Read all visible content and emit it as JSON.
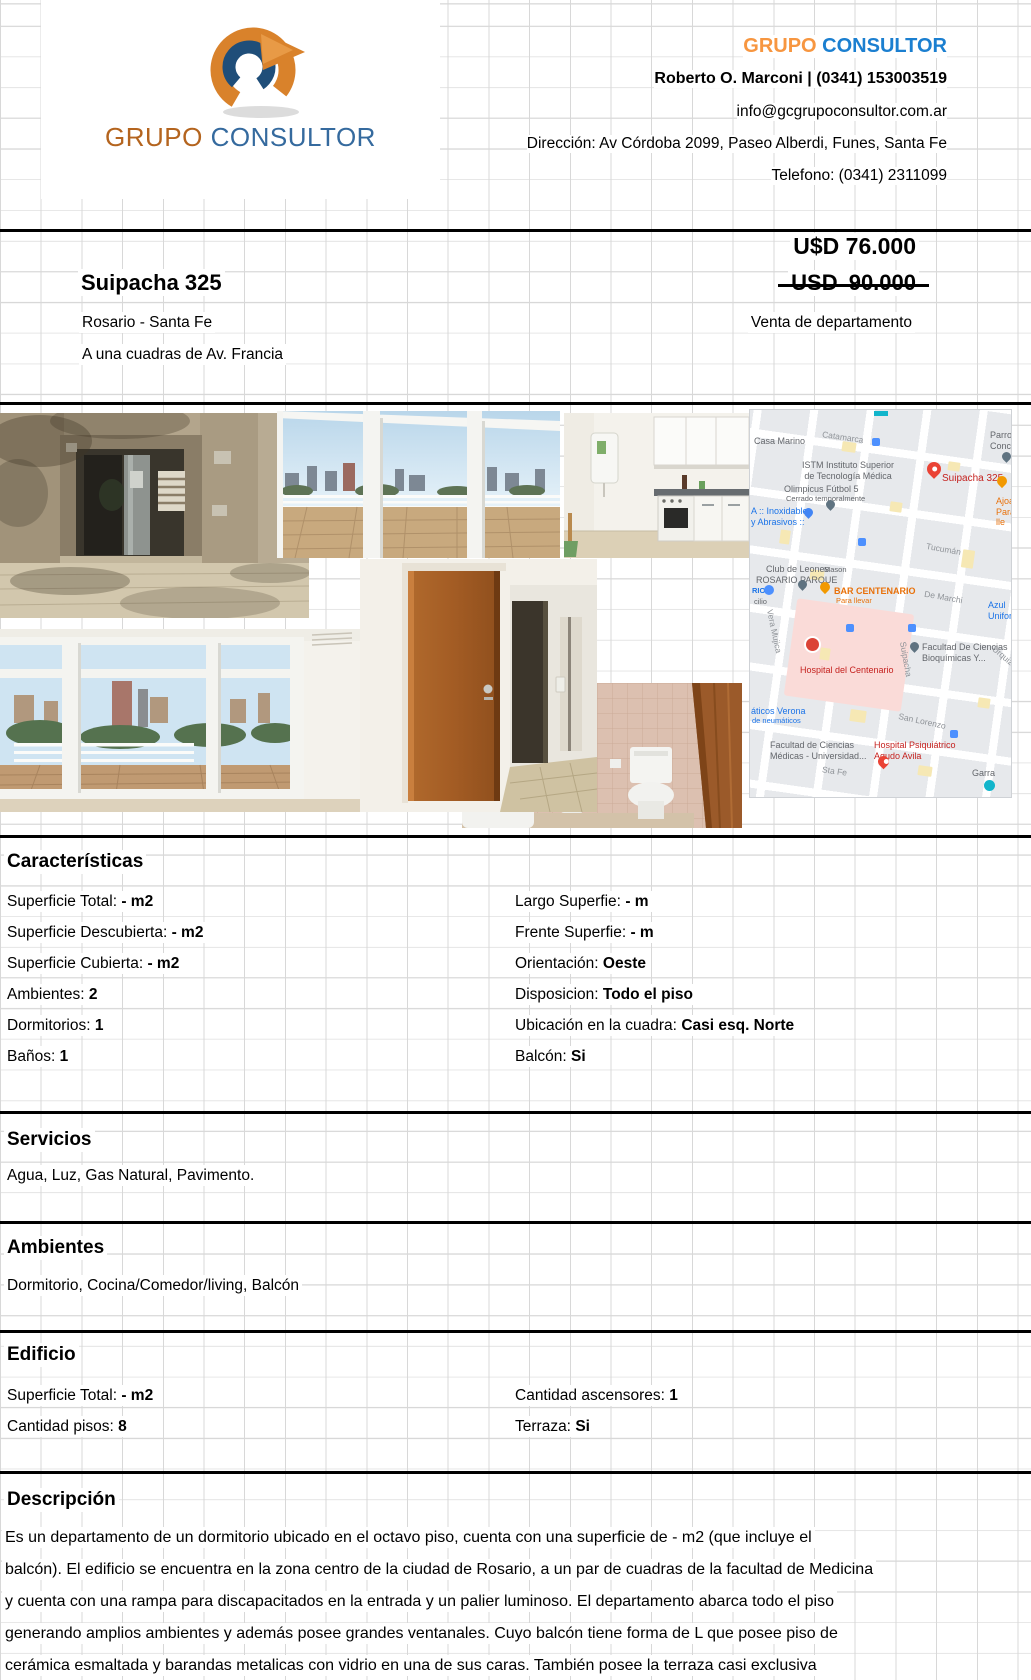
{
  "header": {
    "logo_grupo": "GRUPO",
    "logo_consultor": "CONSULTOR",
    "brand_grupo": "GRUPO",
    "brand_consultor": "CONSULTOR",
    "agent": "Roberto O. Marconi  |  (0341) 153003519",
    "email": "info@gcgrupoconsultor.com.ar",
    "address": "Dirección: Av Córdoba 2099, Paseo Alberdi, Funes, Santa Fe",
    "phone": "Telefono: (0341) 2311099"
  },
  "listing": {
    "price": "U$D 76.000",
    "old_price": "USD  90.000",
    "title": "Suipacha 325",
    "city": "Rosario - Santa Fe",
    "operation": "Venta de departamento",
    "note": "A una cuadras de Av. Francia"
  },
  "caracteristicas": {
    "heading": "Características",
    "left": [
      {
        "label": "Superficie Total:",
        "value": "- m2"
      },
      {
        "label": "Superficie Descubierta:",
        "value": "- m2"
      },
      {
        "label": "Superficie Cubierta:",
        "value": "- m2"
      },
      {
        "label": "Ambientes:",
        "value": "2"
      },
      {
        "label": "Dormitorios:",
        "value": "1"
      },
      {
        "label": "Baños:",
        "value": "1"
      }
    ],
    "right": [
      {
        "label": "Largo Superfie:",
        "value": "- m"
      },
      {
        "label": "Frente Superfie:",
        "value": "- m"
      },
      {
        "label": "Orientación:",
        "value": "Oeste"
      },
      {
        "label": "Disposicion:",
        "value": "Todo el piso"
      },
      {
        "label": "Ubicación en la cuadra:",
        "value": "Casi esq. Norte"
      },
      {
        "label": "Balcón:",
        "value": "Si"
      }
    ]
  },
  "servicios": {
    "heading": "Servicios",
    "text": "Agua, Luz, Gas Natural, Pavimento."
  },
  "ambientes": {
    "heading": "Ambientes",
    "text": "Dormitorio, Cocina/Comedor/living, Balcón"
  },
  "edificio": {
    "heading": "Edificio",
    "left": [
      {
        "label": "Superficie Total:",
        "value": "- m2"
      },
      {
        "label": "Cantidad pisos:",
        "value": "8"
      }
    ],
    "right": [
      {
        "label": "Cantidad ascensores:",
        "value": "1"
      },
      {
        "label": "Terraza:",
        "value": "Si"
      }
    ]
  },
  "descripcion": {
    "heading": "Descripción",
    "lines": [
      "Es un departamento de un dormitorio ubicado en el octavo piso, cuenta con una superficie de - m2 (que incluye el",
      "balcón). El edificio se encuentra en la zona centro de la ciudad de Rosario, a un par de cuadras de la facultad de Medicina",
      "y cuenta con una rampa para discapacitados en la entrada y un palier luminoso. El departamento abarca todo el piso",
      "generando amplios ambientes y además posee grandes ventanales. Cuyo balcón tiene forma de L que  posee piso de",
      "cerámica esmaltada y barandas metalicas con vidrio en una de sus caras. También posee la terraza casi exclusiva"
    ]
  },
  "map": {
    "labels": [
      "Casa Marino",
      "Catamarca",
      "ISTM Instituto Superior\nde Tecnología Médica",
      "Parro\nConc",
      "Olimpicus Fútbol 5",
      "Cerrado temporalmente",
      "A :: Inoxidables\ny Abrasivos ::",
      "Suipacha 325",
      "Ajoarr\nPara lle",
      "Tucumán",
      "Club de Leones",
      "ROSARIO PARQUE",
      "Mason",
      "BAR CENTENARIO",
      "Para llevar",
      "De Marchi",
      "Azul\nUniform",
      "Vera Mujica",
      "Hospital del Centenario",
      "Facultad De Ciencias\nBioquímicas Y...",
      "Urquiza",
      "Suipacha",
      "áticos Verona",
      "de neumáticos",
      "San Lorenzo",
      "Facultad de Ciencias\nMédicas - Universidad...",
      "Hospital Psiquiátrico\nAgudo Avila",
      "Sta Fe",
      "Garra",
      "RIO",
      "cilio"
    ]
  },
  "colors": {
    "brand_orange": "#f79640",
    "brand_blue": "#1b7fd0",
    "map_red": "#c5221f",
    "map_blue": "#1a73e8",
    "map_orange": "#e8710a"
  }
}
